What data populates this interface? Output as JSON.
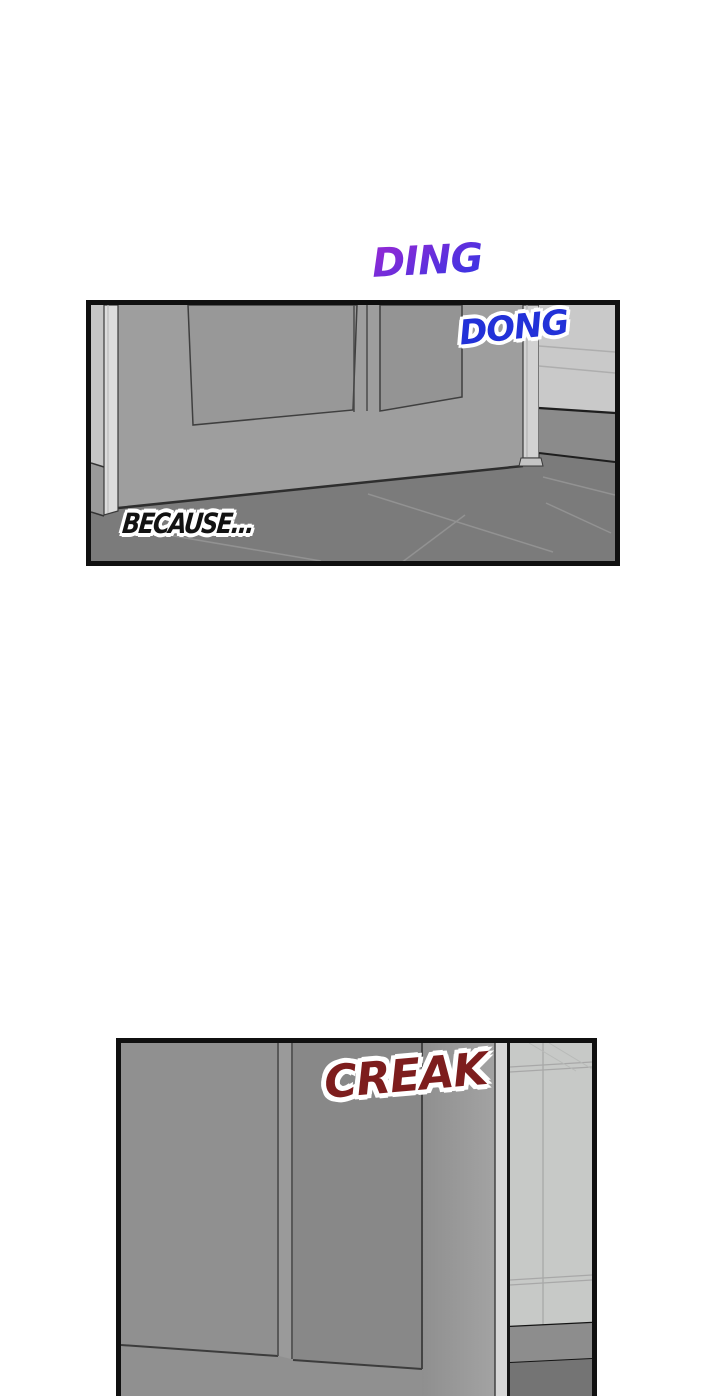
{
  "page": {
    "width": 720,
    "height": 1396,
    "background": "#ffffff",
    "panel_border_color": "#101010"
  },
  "panel1": {
    "description": "Entry door seen at an angle with doorbell ringing",
    "sfx_outside": {
      "text": "DING",
      "color_top": "#8b2ad6",
      "color_bottom": "#4133e2"
    },
    "sfx_inside": {
      "text": "DONG",
      "color": "#2231d8",
      "outline_color": "#ffffff"
    },
    "caption": {
      "text": "BECAUSE...",
      "color": "#121212",
      "outline_color": "#ffffff"
    }
  },
  "panel2": {
    "description": "Close-up of the door creaking open",
    "sfx": {
      "text": "CREAK",
      "color": "#7d1d1d",
      "outline_color": "#ffffff"
    }
  },
  "art_colors": {
    "door_face": "#9e9e9e",
    "door_face_dark": "#909090",
    "door_inset": "#969696",
    "frame_post": "#d8d8d8",
    "wall_light": "#c9c9c9",
    "baseboard": "#8b8b8b",
    "floor": "#7b7b7b",
    "tile_wall": "#c7c9c7",
    "line_dark": "#2e2e2e"
  }
}
